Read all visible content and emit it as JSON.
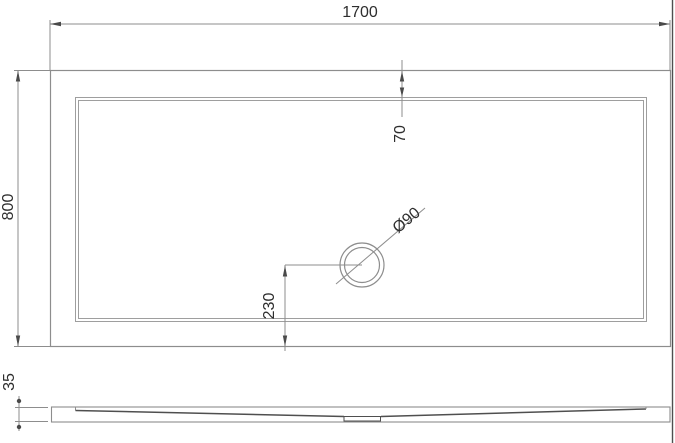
{
  "drawing": {
    "type": "technical-drawing",
    "subject": "rectangular shower tray - plan view and side profile",
    "labels": {
      "width": "1700",
      "depth": "800",
      "rim_inset": "70",
      "drain_diameter": "Ø90",
      "drain_offset_from_bottom": "230",
      "tray_height": "35"
    },
    "colors": {
      "background": "#ffffff",
      "line": "#8d8d8d",
      "inner_line": "#9e9e9e",
      "accent_line": "#4f4f4f",
      "arrow": "#4a4a4a",
      "text": "#2e2e2e"
    }
  }
}
